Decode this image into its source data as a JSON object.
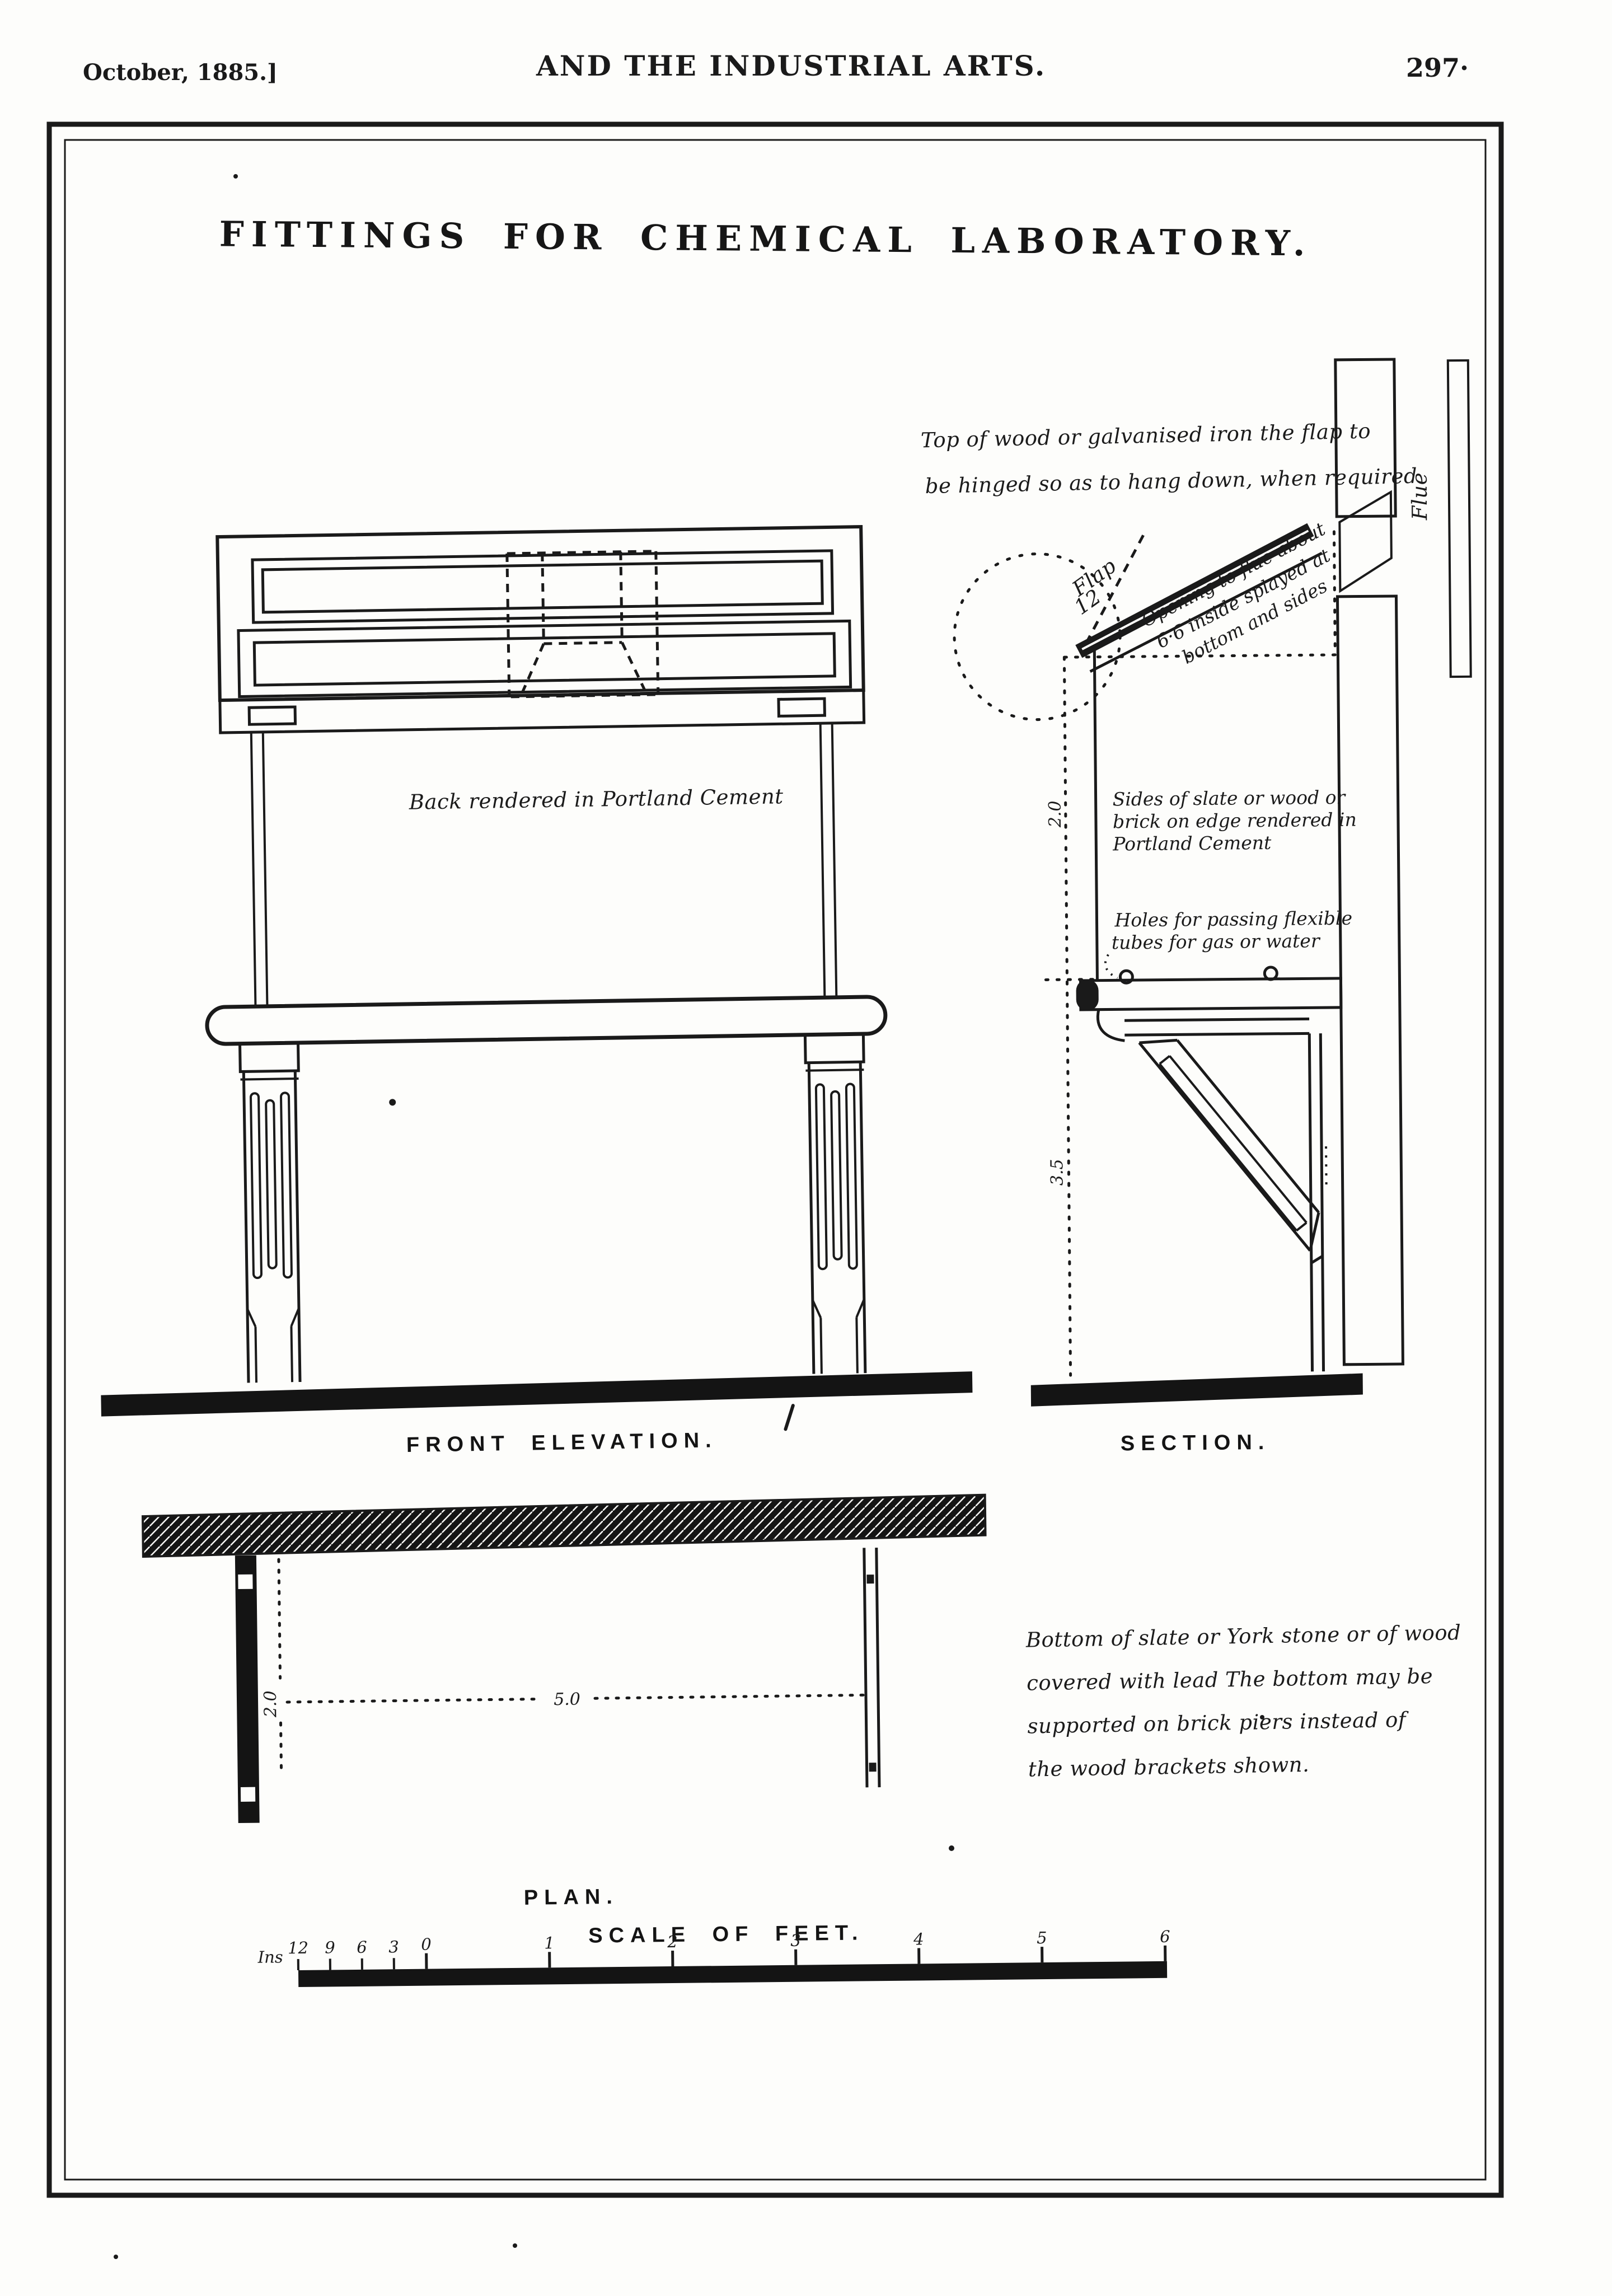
{
  "page": {
    "paper_color": "#fdfdfb",
    "ink_color": "#1a1a1a"
  },
  "header": {
    "date": "October, 1885.]",
    "journal": "AND THE INDUSTRIAL ARTS.",
    "page_number": "297·"
  },
  "plate": {
    "title": "FITTINGS FOR CHEMICAL LABORATORY."
  },
  "views": {
    "front_elevation": "FRONT ELEVATION.",
    "section": "SECTION.",
    "plan": "PLAN.",
    "scale_title": "SCALE OF FEET."
  },
  "annotations": {
    "top_note": {
      "line1": "Top of wood or galvanised iron  the flap to",
      "line2": "be hinged so as to hang down, when required"
    },
    "flap": {
      "line1": "Flap",
      "line2": "12"
    },
    "opening_note": {
      "line1": "Opening to flue about",
      "line2": "6·6 inside splayed at",
      "line3": "bottom and sides"
    },
    "flue_label": "Flue",
    "back_note": "Back rendered in Portland Cement",
    "sides_note": {
      "line1": "Sides of slate or wood or",
      "line2": "brick on edge rendered in",
      "line3": "Portland Cement"
    },
    "holes_note": {
      "line1": "Holes for passing flexible",
      "line2": "tubes for gas or water"
    },
    "bottom_note": {
      "line1": "Bottom of slate or York stone or of wood",
      "line2": "covered with lead  The bottom may be",
      "line3": "supported on brick piers instead of",
      "line4": "the wood brackets shown."
    }
  },
  "dimensions": {
    "section_upper": "2.0",
    "section_lower": "3.5",
    "plan_length": "5.0",
    "plan_depth": "2.0"
  },
  "scale_bar": {
    "ins_label": "Ins",
    "inch_ticks": [
      "12",
      "9",
      "6",
      "3",
      "0"
    ],
    "foot_ticks": [
      "1",
      "2",
      "3",
      "4",
      "5",
      "6"
    ]
  }
}
